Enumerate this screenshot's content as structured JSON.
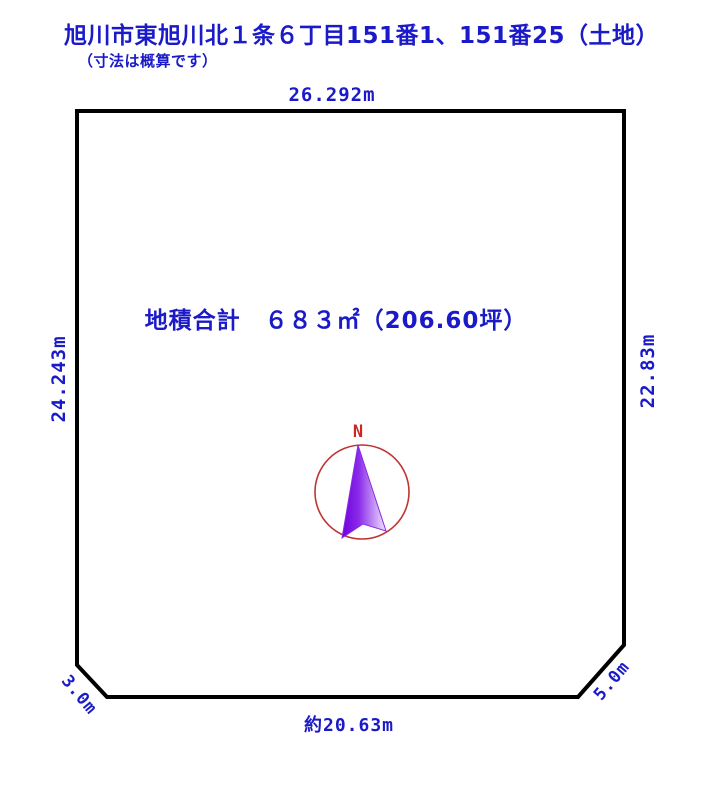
{
  "title": "旭川市東旭川北１条６丁目151番1、151番25（土地）",
  "subtitle": "（寸法は概算です）",
  "area_label": "地積合計　６８３㎡（206.60坪）",
  "dimensions": {
    "top": "26.292m",
    "left": "24.243m",
    "right": "22.83m",
    "bottom": "約20.63m",
    "corner_left": "3.0m",
    "corner_right": "5.0m"
  },
  "compass": {
    "north_label": "N"
  },
  "colors": {
    "text_blue": "#1a1ac8",
    "plot_outline": "#000000",
    "compass_red": "#c03434",
    "north_letter_red": "#cc2626",
    "arrow_purple_dark": "#7a00e6",
    "arrow_purple_light": "#f0e4fd"
  }
}
